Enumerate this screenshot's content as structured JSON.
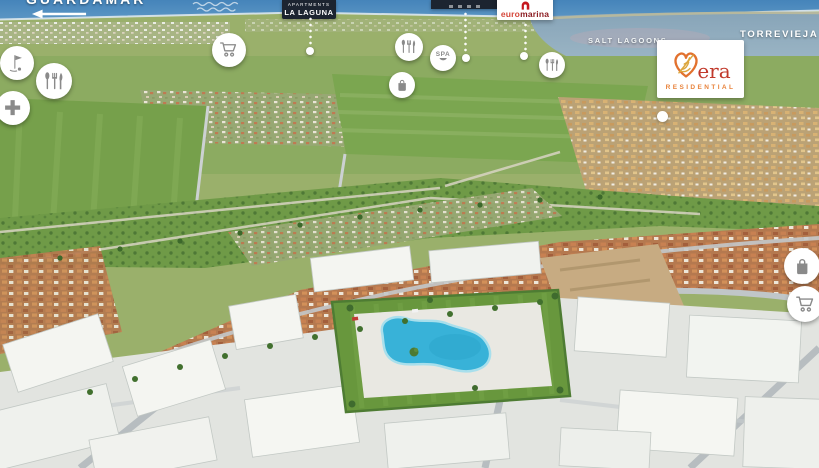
{
  "overlay": {
    "guardamar": {
      "label": "GUARDAMAR",
      "arrow_direction": "left"
    },
    "torrevieja": {
      "label": "TORREVIEJA",
      "arrow_direction": "up"
    },
    "salt_lagoons": {
      "label": "SALT LAGOONS"
    },
    "la_laguna_badge": {
      "line1": "APARTMENTS",
      "line2": "LA LAGUNA"
    },
    "cropped_badge": {
      "visible_text": ""
    },
    "euromarina": {
      "text_light": "euro",
      "text_dark": "marina"
    },
    "vera": {
      "brand": "Vera",
      "wordmark": "era",
      "subtitle": "RESIDENTIAL"
    }
  },
  "markers": [
    {
      "icon": "golf-flag-icon",
      "x": 17,
      "y": 63,
      "r": 17
    },
    {
      "icon": "restaurant-icon",
      "x": 54,
      "y": 81,
      "r": 18
    },
    {
      "icon": "medical-cross-icon",
      "x": 13,
      "y": 108,
      "r": 17
    },
    {
      "icon": "shopping-cart-icon",
      "x": 229,
      "y": 50,
      "r": 17
    },
    {
      "icon": "restaurant-icon",
      "x": 409,
      "y": 47,
      "r": 14
    },
    {
      "icon": "spa-icon",
      "label": "SPA",
      "x": 443,
      "y": 58,
      "r": 13
    },
    {
      "icon": "shopping-bag-icon",
      "x": 402,
      "y": 85,
      "r": 13
    },
    {
      "icon": "restaurant-icon",
      "x": 552,
      "y": 65,
      "r": 13
    },
    {
      "icon": "shopping-bag-icon",
      "x": 802,
      "y": 266,
      "r": 18
    },
    {
      "icon": "shopping-cart-icon",
      "x": 805,
      "y": 304,
      "r": 18
    }
  ],
  "callouts": {
    "lines": [
      {
        "x": 310,
        "y1": 16,
        "y2": 46
      },
      {
        "x": 465,
        "y1": 11,
        "y2": 53
      },
      {
        "x": 525,
        "y1": 22,
        "y2": 51
      }
    ],
    "dots": [
      {
        "x": 310,
        "y": 51,
        "r": 4
      },
      {
        "x": 466,
        "y": 58,
        "r": 4
      },
      {
        "x": 524,
        "y": 56,
        "r": 4
      },
      {
        "x": 662,
        "y": 116,
        "r": 5.5
      }
    ]
  },
  "colors": {
    "badge_bg": "#1c2430",
    "euromarina_mark_red": "#c5171d",
    "euromarina_light_red": "#d5473a",
    "euromarina_dark_red": "#8c1d22",
    "vera_red": "#c13a2c",
    "vera_orange": "#e8833c",
    "marker_icon_gray": "#8a8a8a",
    "pool_blue": "#38b2d8"
  }
}
